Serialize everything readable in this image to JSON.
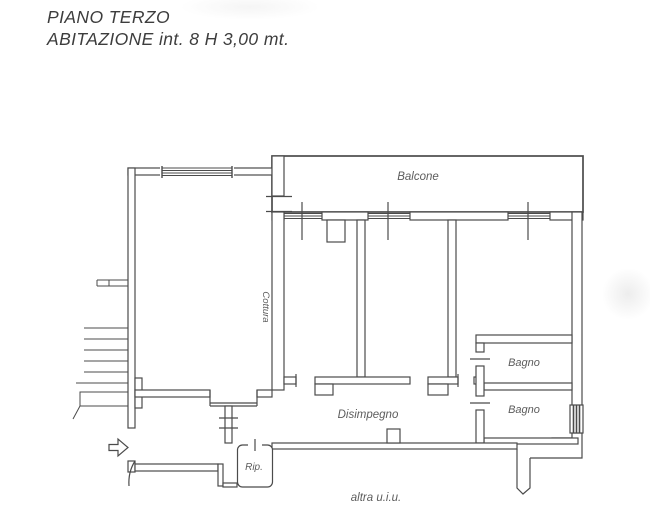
{
  "header": {
    "line1": "PIANO TERZO",
    "line2": "ABITAZIONE int. 8 H 3,00 mt."
  },
  "plan": {
    "type": "floor-plan",
    "labels": {
      "balcony": "Balcone",
      "cooking": "Cottura",
      "bathroom_upper": "Bagno",
      "bathroom_lower": "Bagno",
      "hallway": "Disimpegno",
      "storage": "Rip.",
      "other_unit": "altra u.i.u."
    },
    "colors": {
      "line": "#4b4b4b",
      "label": "#5c5c5c",
      "title": "#3d3d3d",
      "background": "#ffffff"
    }
  }
}
